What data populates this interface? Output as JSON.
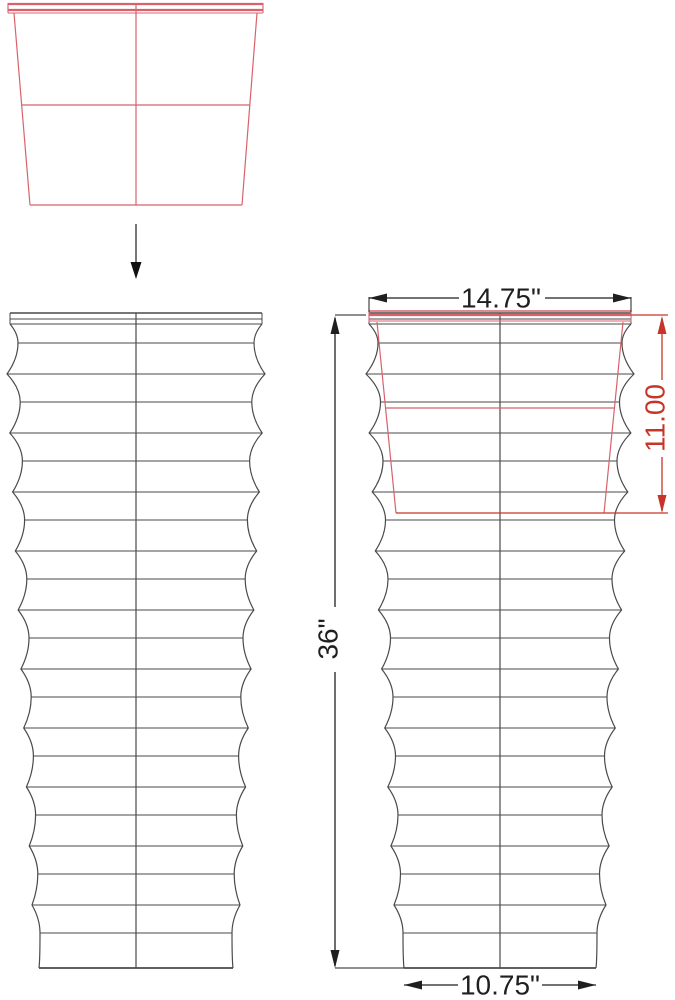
{
  "title": "Tall ribbed planter with insert pot - dimensioned technical drawing",
  "labels": {
    "top_width": "14.75\"",
    "insert_depth": "11.00",
    "total_height": "36\"",
    "bottom_width": "10.75\""
  },
  "colors": {
    "background": "#ffffff",
    "drawing_line": "#4a4a4a",
    "dimension_line": "#1f1f1f",
    "accent_red": "#c63528",
    "pot_red": "#d8626c"
  },
  "drawing": {
    "pot_top_view": {
      "rim_x1": 8,
      "rim_x2": 263,
      "rim_y_top": 3,
      "rim_line_ys": [
        4,
        10,
        13
      ],
      "body": {
        "top_y": 13,
        "bottom_y": 205,
        "top_left": 14,
        "top_right": 257,
        "bottom_left": 30,
        "bottom_right": 242
      },
      "mid_line_y": 105,
      "center_x": 136
    },
    "arrow": {
      "x": 136,
      "y1": 224,
      "y2": 262,
      "tip_y": 279,
      "half_width": 5.5
    },
    "rib": {
      "first_trough_y": 343,
      "first_peak_y": 374,
      "spacing": 59,
      "troughs": 11,
      "peaks": 10
    },
    "planter_left": {
      "cx": 136,
      "top_y": 313,
      "base_y": 968,
      "rim_half": 126,
      "peak_half": [
        129,
        104
      ],
      "trough_half": [
        118,
        96
      ],
      "base_half": 97
    },
    "planter_right": {
      "cx": 500,
      "top_y": 313,
      "base_y": 968,
      "rim_half": 131,
      "peak_half": [
        134,
        106
      ],
      "trough_half": [
        122,
        97
      ],
      "base_half": 96
    },
    "insert_overlay": {
      "rim_x1": 369,
      "rim_x2": 631,
      "rim_y_top": 309,
      "rim_y_bot": 322,
      "rim_line_ys": [
        311,
        315,
        321
      ],
      "body": {
        "top_y": 322,
        "bottom_y": 513,
        "top_left": 377,
        "top_right": 623,
        "bottom_left": 396,
        "bottom_right": 604
      },
      "mid_line_y": 408,
      "ext_x": 668
    },
    "dims": {
      "top_width": {
        "y": 298,
        "x1": 369,
        "x2": 631,
        "gap": [
          459,
          545
        ],
        "ext_y1": 297,
        "ext_y2": 312
      },
      "total_height": {
        "x": 335,
        "y1": 316,
        "y2": 968,
        "gap": [
          607,
          672
        ],
        "ext_top": [
          335,
          366,
          315
        ],
        "ext_bottom": [
          335,
          404,
          968
        ]
      },
      "insert_depth": {
        "x": 662,
        "y1": 316,
        "y2": 513,
        "gap": [
          380,
          457
        ]
      },
      "bottom_width": {
        "y": 985,
        "x1": 404,
        "x2": 596,
        "gap": [
          458,
          542
        ]
      }
    }
  }
}
